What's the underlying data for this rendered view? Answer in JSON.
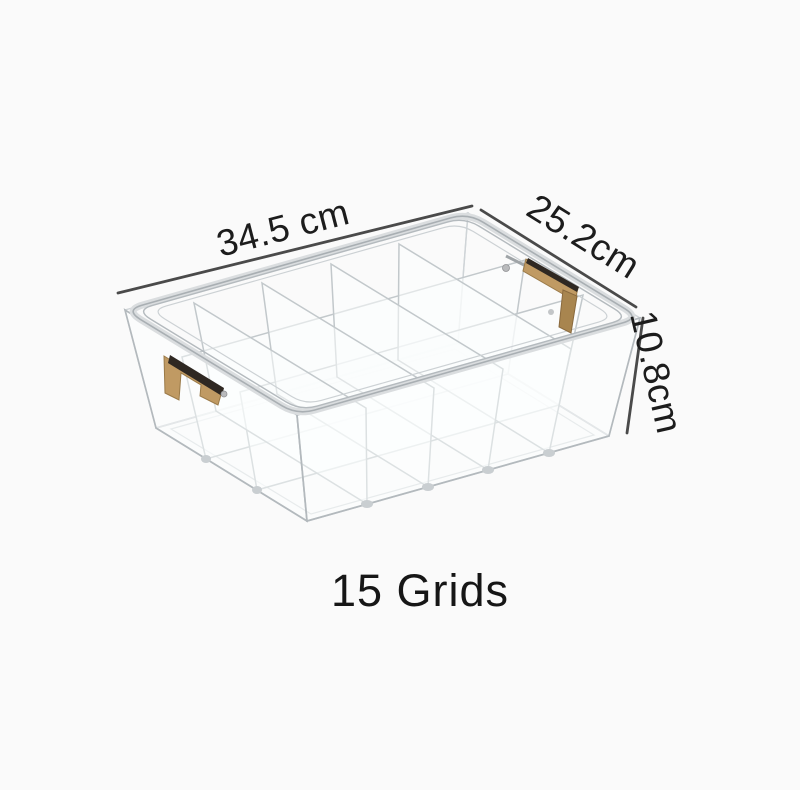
{
  "image": {
    "background_color": "#fafafa",
    "caption": {
      "text": "15 Grids",
      "color": "#161616"
    },
    "dimensions": {
      "length_label": "34.5 cm",
      "width_label": "25.2cm",
      "height_label": "10.8cm",
      "line_color": "#4a4a4a",
      "text_color": "#1c1c1c"
    },
    "product": {
      "type": "transparent grid storage organizer box",
      "grid_rows": 3,
      "grid_columns": 5,
      "total_grids": 15,
      "frame_color": "#aab0b4",
      "tube_color": "#dadddf",
      "panel_edge_color": "#c2c8cb",
      "handle_wood_color": "#c09a63",
      "handle_wood_shadow": "#9a7a48",
      "handle_trim_dark": "#2f2822",
      "metal_color": "#9fa4a7"
    }
  }
}
